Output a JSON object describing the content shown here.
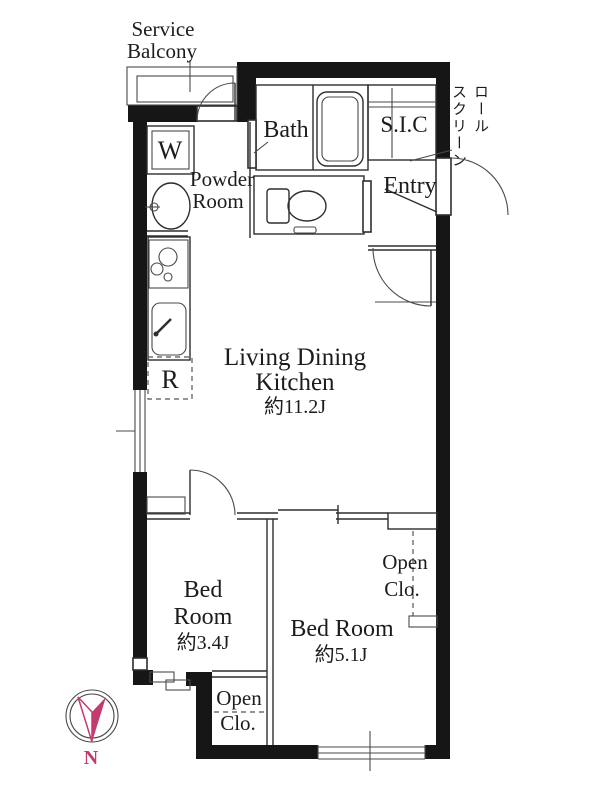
{
  "colors": {
    "walls": "#161616",
    "lines": "#2e2e2e",
    "compass_accent": "#c23a6e",
    "background": "#ffffff"
  },
  "labels": {
    "service_balcony": {
      "line1": "Service",
      "line2": "Balcony"
    },
    "bath": "Bath",
    "shoe_closet": "S.I.C",
    "roll_screen": {
      "col_right": "ロール",
      "col_left": "スクリーン"
    },
    "entry": "Entry",
    "powder_room": {
      "line1": "Powder",
      "line2": "Room"
    },
    "washing_machine": "W",
    "refrigerator": "R",
    "living_dining_kitchen": {
      "line1": "Living Dining",
      "line2": "Kitchen",
      "area": "約11.2J"
    },
    "bedroom_34": {
      "line1": "Bed",
      "line2": "Room",
      "area": "約3.4J"
    },
    "bedroom_51": {
      "line1": "Bed Room",
      "area": "約5.1J"
    },
    "open_closet_bedroom_34": {
      "line1": "Open",
      "line2": "Clo."
    },
    "open_closet_bedroom_51": {
      "line1": "Open",
      "line2": "Clo."
    },
    "compass_north": "N"
  }
}
